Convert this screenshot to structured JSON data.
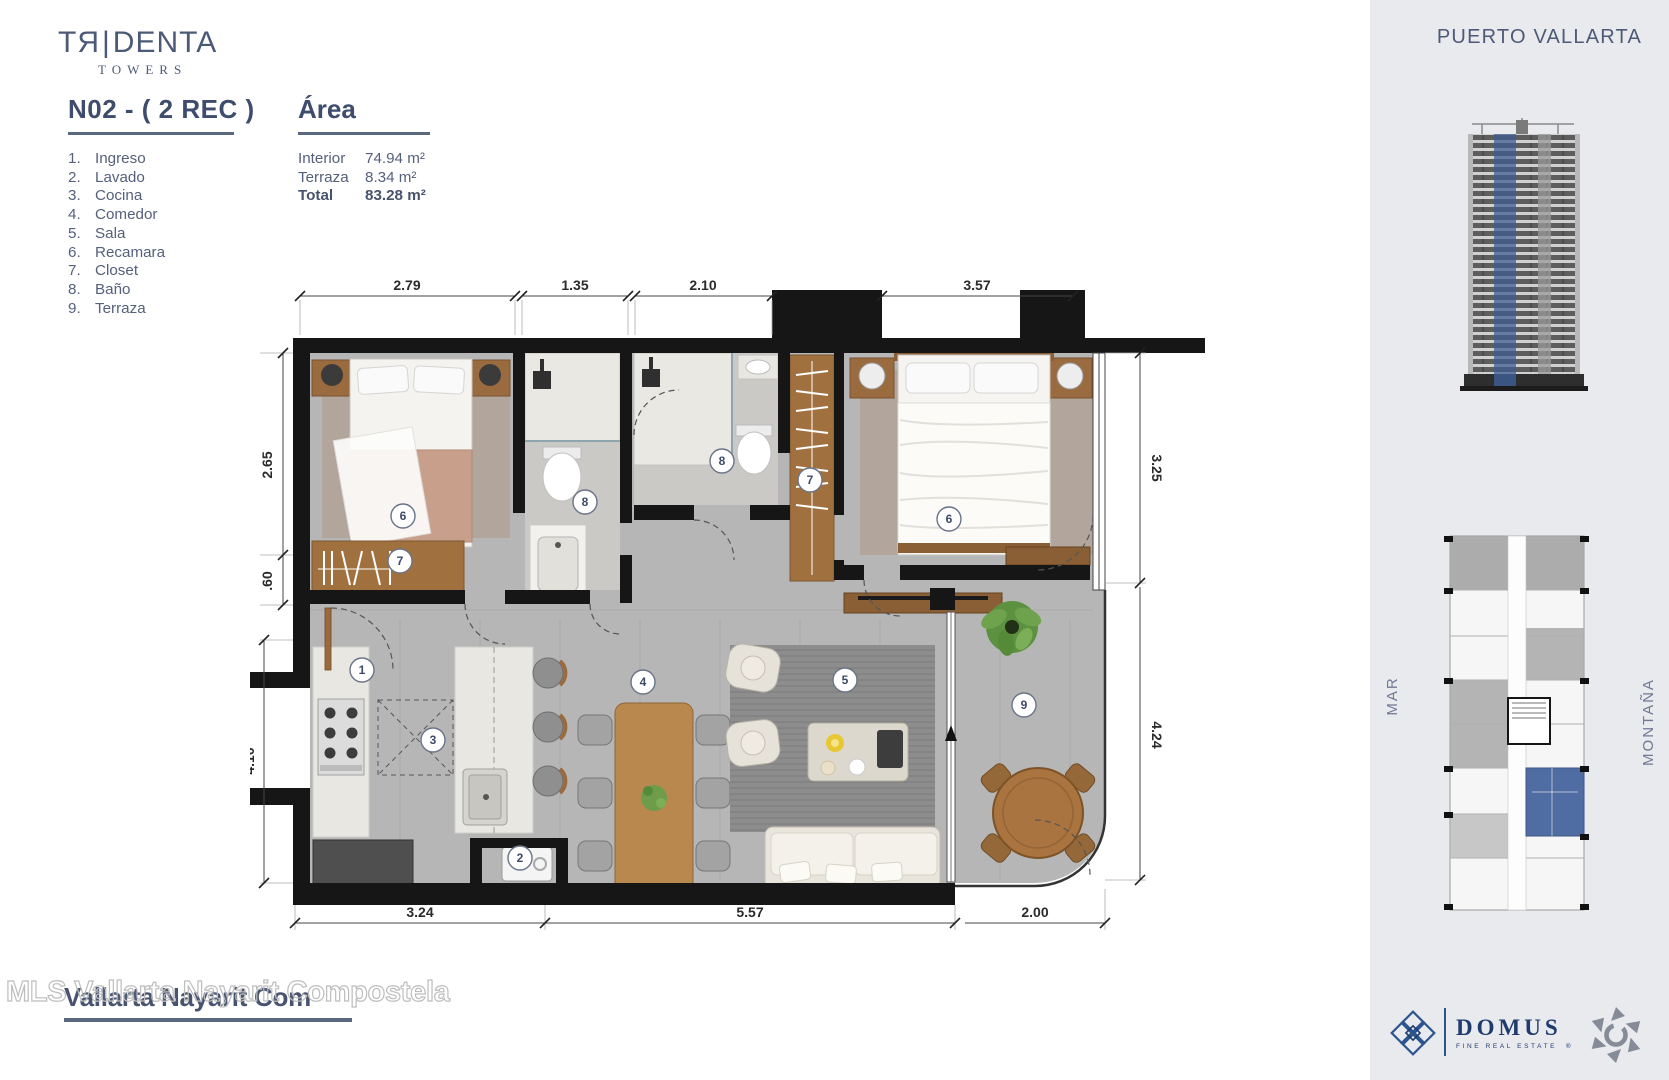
{
  "brand": {
    "wordmark_left": "TЯ",
    "wordmark_bar": "|",
    "wordmark_right": "DENTA",
    "sub": "TOWERS"
  },
  "unit": {
    "title": "N02 - ( 2 REC )"
  },
  "legend": {
    "items": [
      {
        "num": "1.",
        "label": "Ingreso"
      },
      {
        "num": "2.",
        "label": "Lavado"
      },
      {
        "num": "3.",
        "label": "Cocina"
      },
      {
        "num": "4.",
        "label": "Comedor"
      },
      {
        "num": "5.",
        "label": "Sala"
      },
      {
        "num": "6.",
        "label": "Recamara"
      },
      {
        "num": "7.",
        "label": "Closet"
      },
      {
        "num": "8.",
        "label": "Baño"
      },
      {
        "num": "9.",
        "label": "Terraza"
      }
    ]
  },
  "area": {
    "title": "Área",
    "rows": [
      {
        "label": "Interior",
        "value": "74.94 m²"
      },
      {
        "label": "Terraza",
        "value": "8.34 m²"
      },
      {
        "label": "Total",
        "value": "83.28 m²"
      }
    ]
  },
  "plan": {
    "dims": {
      "top": [
        "2.79",
        "1.35",
        "2.10",
        "3.57"
      ],
      "left": [
        "2.65",
        ".60",
        "4.10"
      ],
      "right": [
        "3.25",
        "4.24"
      ],
      "bottom": [
        "3.24",
        "5.57",
        "2.00"
      ]
    },
    "badges": [
      "6",
      "7",
      "8",
      "8",
      "7",
      "6",
      "1",
      "3",
      "2",
      "4",
      "5",
      "9"
    ]
  },
  "sidebar": {
    "location": "PUERTO VALLARTA",
    "orientation": {
      "sea": "MAR",
      "mountain": "MONTAÑA"
    },
    "domus": {
      "name": "DOMUS",
      "tagline": "FINE REAL ESTATE",
      "reg": "®"
    }
  },
  "watermark": {
    "outline": "MLS Vallarta Nayarit Compostela",
    "overlay": "Vallarta Nayarit Com"
  },
  "colors": {
    "accent": "#4d5a77",
    "highlight_unit": "#4f6da3",
    "wall": "#161616",
    "wood": "#a0713f",
    "sidebar_bg": "#e8eaee"
  }
}
